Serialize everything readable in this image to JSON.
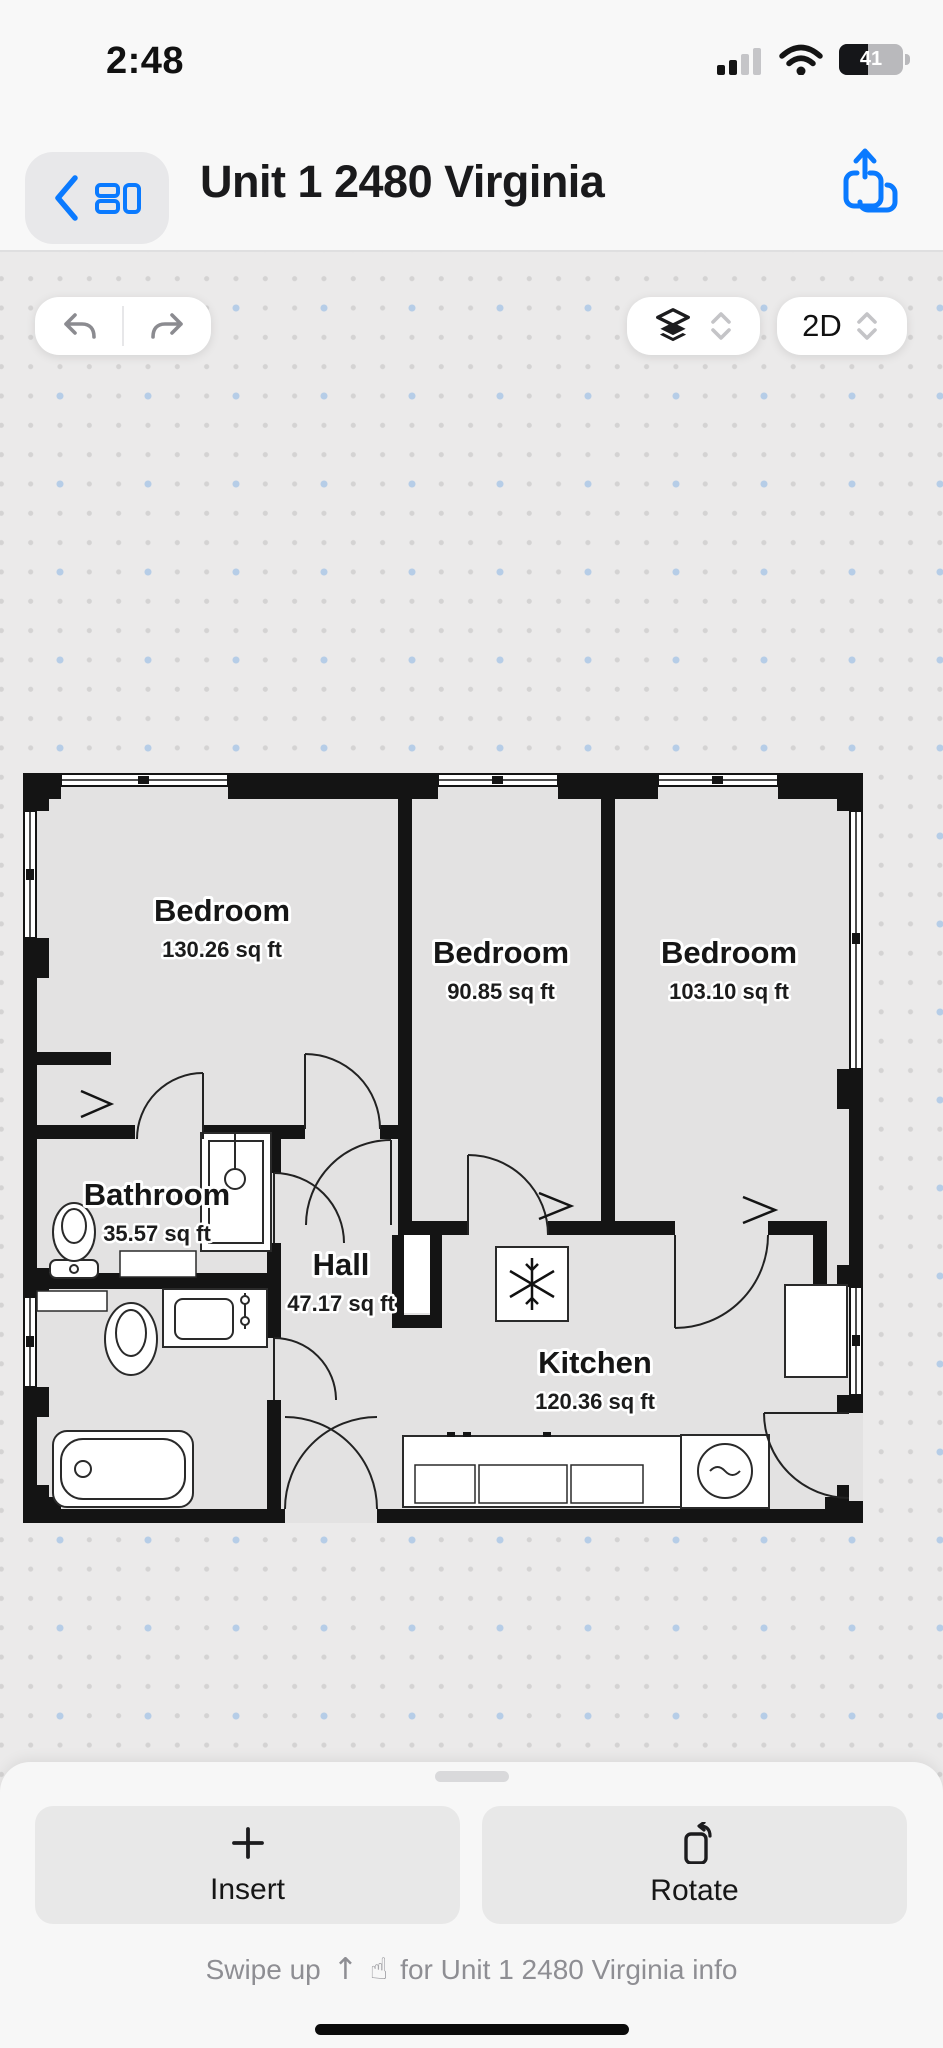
{
  "status_bar": {
    "time": "2:48",
    "battery_level": "41"
  },
  "header": {
    "title": "Unit 1 2480 Virginia"
  },
  "canvas_toolbar": {
    "view_mode": "2D"
  },
  "floor_plan": {
    "rooms": [
      {
        "name": "Bedroom",
        "area": "130.26 sq ft"
      },
      {
        "name": "Bedroom",
        "area": "90.85 sq ft"
      },
      {
        "name": "Bedroom",
        "area": "103.10 sq ft"
      },
      {
        "name": "Bathroom",
        "area": "35.57 sq ft"
      },
      {
        "name": "Hall",
        "area": "47.17 sq ft"
      },
      {
        "name": "Kitchen",
        "area": "120.36 sq ft"
      }
    ]
  },
  "bottom_sheet": {
    "insert_label": "Insert",
    "rotate_label": "Rotate",
    "swipe_hint_prefix": "Swipe up",
    "swipe_hint_suffix": "for Unit 1 2480 Virginia info"
  },
  "colors": {
    "accent_blue": "#0a7aff",
    "wall_black": "#141414",
    "floor_gray": "#e3e2e2",
    "canvas_gray": "#ebeaea"
  }
}
